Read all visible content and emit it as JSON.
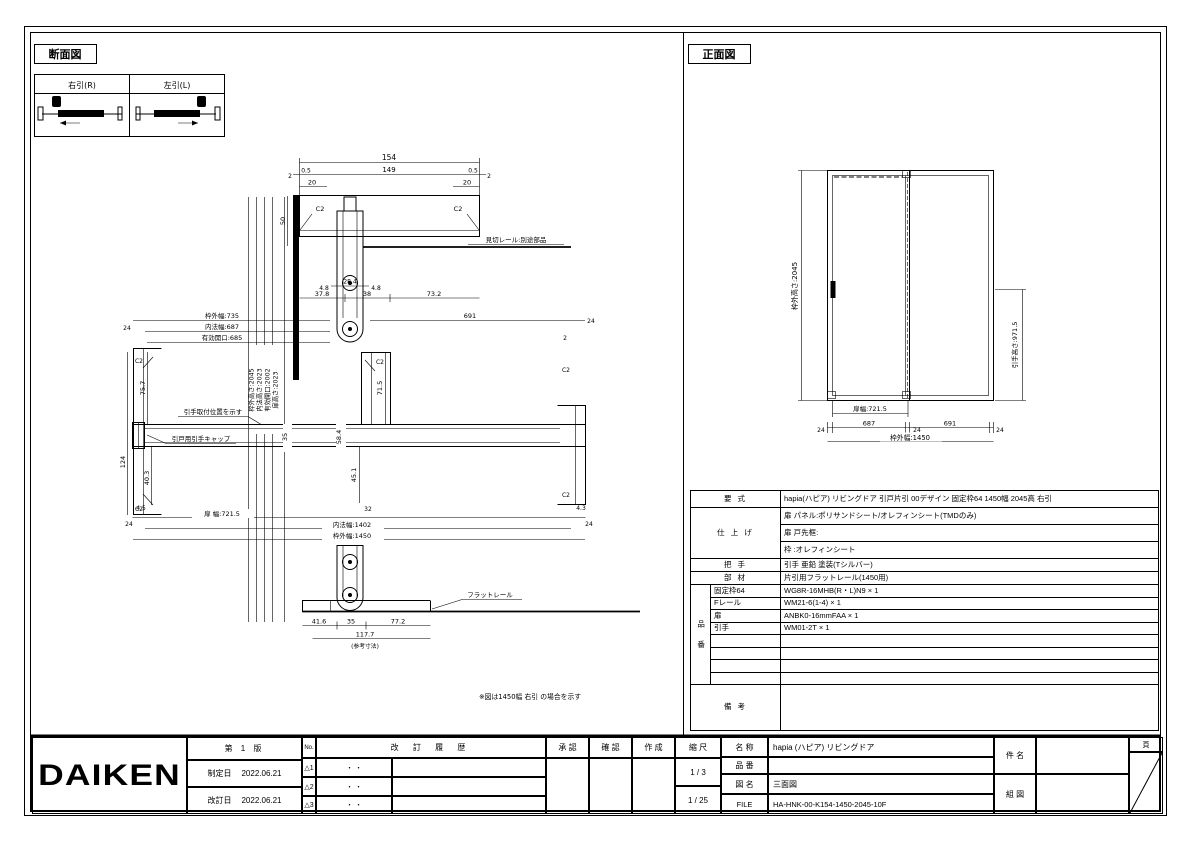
{
  "sheet": {
    "left_view_title": "断面図",
    "right_view_title": "正面図",
    "variant_right": "右引(R)",
    "variant_left": "左引(L)",
    "note": "※図は1450幅 右引 の場合を示す"
  },
  "top_detail": {
    "chamfer_left": "C2",
    "chamfer_right": "C2",
    "rail_note": "見切レール:別途部品",
    "dim_total": "154",
    "dim_2l": "2",
    "dim_05l": "0.5",
    "dim_149": "149",
    "dim_05r": "0.5",
    "dim_2r": "2",
    "dim_20l": "20",
    "dim_20r": "20",
    "dim_50": "50",
    "dim_48l": "4.8",
    "dim_284": "28.4",
    "dim_48r": "4.8",
    "dim_378": "37.8",
    "dim_38": "38",
    "dim_732": "73.2"
  },
  "mid_section": {
    "w_out": "枠外幅:735",
    "w_in": "内法幅:687",
    "w_open": "有効開口:685",
    "d_691": "691",
    "d_24tl": "24",
    "d_24tr": "24",
    "d_2": "2",
    "v_757": "75.7",
    "v_124": "124",
    "v_403": "40.3",
    "d_45": "4.5",
    "v_715": "71.5",
    "v_584": "58.4",
    "v_451": "45.1",
    "v_35": "35",
    "d_43": "4.3",
    "d_32": "32",
    "d_24bl": "24",
    "d_24br": "24",
    "door_w": "扉 幅:721.5",
    "inner_w": "内法幅:1402",
    "outer_w": "枠外幅:1450",
    "heights": [
      "枠外高さ:2045",
      "内法高さ:2023",
      "有効開口:2002",
      "扉高さ:2023"
    ],
    "label_handle_pos": "引手取付位置を示す",
    "label_handle_cap": "引戸用引手キャップ",
    "chamfer": "C2"
  },
  "bottom_detail": {
    "rail_label": "フラットレール",
    "d_416": "41.6",
    "d_35": "35",
    "d_772": "77.2",
    "d_1177": "117.7",
    "d_note": "(参考寸法)"
  },
  "front_view": {
    "height_label": "枠外高さ:2045",
    "handle_label": "引手高さ:971.5",
    "door_width": "扉幅:721.5",
    "d_24a": "24",
    "d_687": "687",
    "d_24b": "24",
    "d_691": "691",
    "d_24c": "24",
    "total_width": "枠外幅:1450"
  },
  "spec": {
    "yoshiki_label": "要  式",
    "yoshiki_value": "hapia(ハピア) リビングドア 引戸片引 00デザイン 固定枠64 1450幅 2045高 右引",
    "shiage_label": "仕 上 げ",
    "shiage_1": "扉 パネル:ポリサンドシート/オレフィンシート(TMDのみ)",
    "shiage_2": "扉 戸先框:",
    "shiage_3": "枠      :オレフィンシート",
    "totte_label": "把  手",
    "totte_value": "引手 亜鉛 塗装(Tシルバー)",
    "buzai_label": "部  材",
    "buzai_value": "片引用フラットレール(1450用)",
    "hinban_label": "品 番",
    "hinban": [
      {
        "name": "固定枠64",
        "value": "WG8R-16MHB(R・L)N9 × 1"
      },
      {
        "name": "Fレール",
        "value": "WM21-6(1-4) × 1"
      },
      {
        "name": "扉",
        "value": "ANBK0-16mmFAA × 1"
      },
      {
        "name": "引手",
        "value": "WM01-2T × 1"
      },
      {
        "name": "",
        "value": ""
      },
      {
        "name": "",
        "value": ""
      },
      {
        "name": "",
        "value": ""
      },
      {
        "name": "",
        "value": ""
      }
    ],
    "biko_label": "備  考"
  },
  "title_block": {
    "logo": "DAIKEN",
    "edition": "第 1 版",
    "established_label": "制定日",
    "established_date": "2022.06.21",
    "revised_label": "改訂日",
    "revised_date": "2022.06.21",
    "no_label": "No.",
    "history_label": "改 訂 履 歴",
    "rev_marks": [
      "△1",
      "△2",
      "△3"
    ],
    "rev_dots": [
      "・  ・",
      "・  ・",
      "・  ・"
    ],
    "approve_label": "承 認",
    "check_label": "確 認",
    "create_label": "作 成",
    "scale_label": "縮 尺",
    "scale_1": "1 / 3",
    "scale_2": "1 / 25",
    "name_label": "名 称",
    "name_value": "hapia (ハピア) リビングドア",
    "pn_label": "品 番",
    "pn_value": "",
    "zumei_label": "図 名",
    "zumei_value": "三面図",
    "file_label": "FILE",
    "file_value": "HA-HNK-00-K154-1450-2045-10F",
    "kenmei_label": "件 名",
    "kumizu_label": "組 図",
    "page_label": "頁"
  }
}
